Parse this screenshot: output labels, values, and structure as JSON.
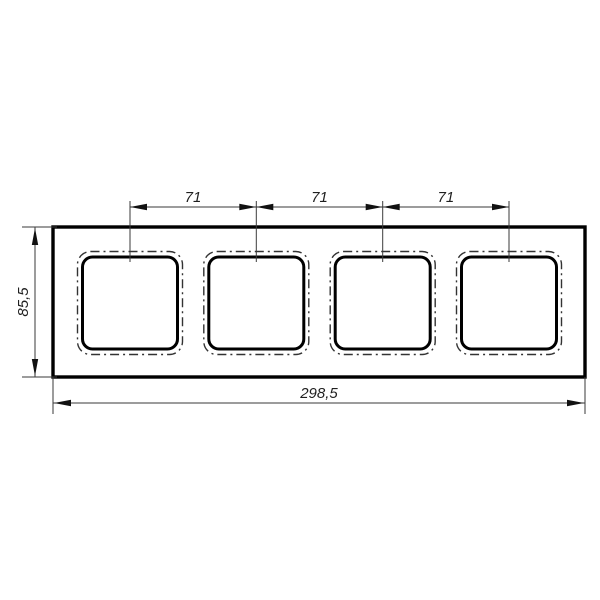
{
  "drawing": {
    "kind": "technical-dimension-drawing",
    "part": {
      "description": "rectangular frame plate with four square openings",
      "openings_visible": 4
    },
    "dimensions": {
      "spacing": [
        "71",
        "71",
        "71"
      ],
      "height": "85,5",
      "width": "298,5"
    },
    "colors": {
      "background": "#ffffff",
      "thick_line": "#000000",
      "thin_line": "#3a3a3a",
      "phantom_line": "#333333"
    }
  }
}
